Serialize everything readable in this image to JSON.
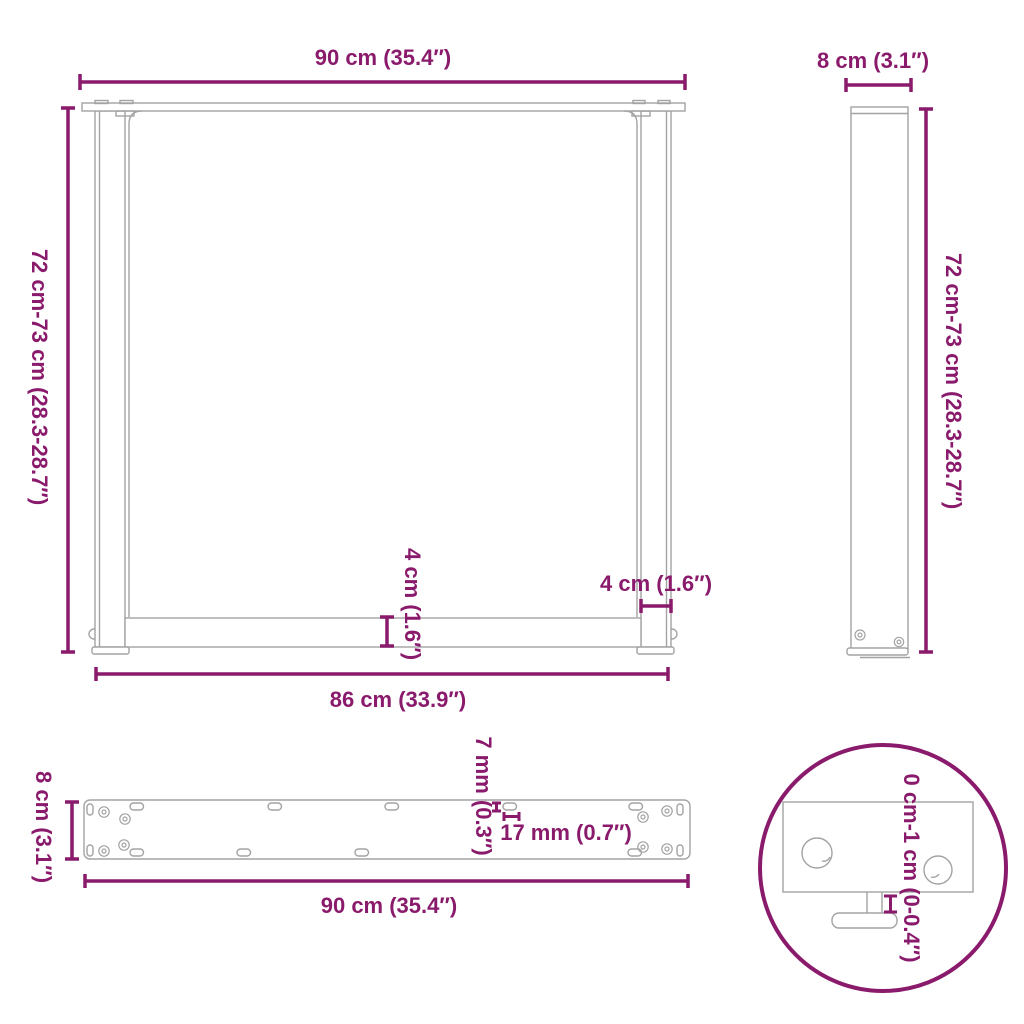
{
  "colors": {
    "accent": "#8a1a6b",
    "drawing_line": "#a3a3a3",
    "background": "#ffffff"
  },
  "views": {
    "front": {
      "width_top": "90 cm (35.4″)",
      "height": "72 cm-73 cm (28.3-28.7″)",
      "crossbar_height": "4 cm (1.6″)",
      "leg_width": "4 cm (1.6″)",
      "width_bottom": "86 cm (33.9″)"
    },
    "side": {
      "depth": "8 cm (3.1″)",
      "height": "72 cm-73 cm (28.3-28.7″)"
    },
    "top": {
      "depth": "8 cm (3.1″)",
      "slot_height": "7 mm (0.3″)",
      "slot_width": "17 mm (0.7″)",
      "width": "90 cm (35.4″)"
    },
    "detail": {
      "adjustable_height": "0 cm-1 cm (0-0.4″)"
    }
  }
}
